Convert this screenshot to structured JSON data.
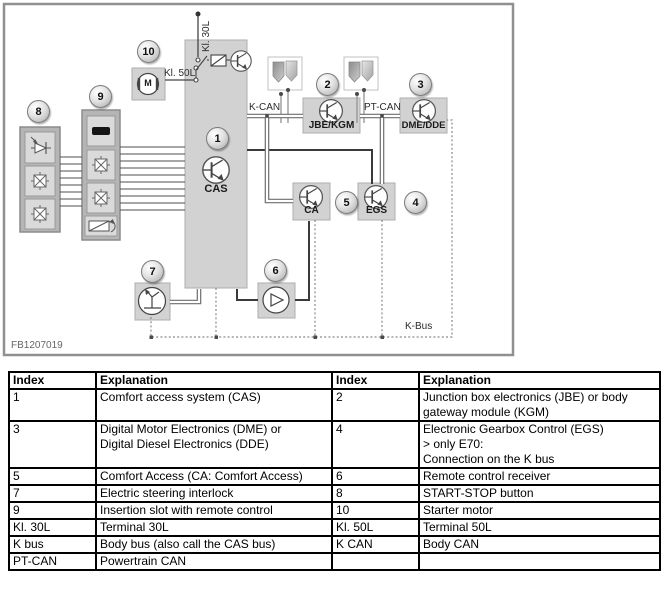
{
  "diagram": {
    "figure_id": "FB1207019",
    "labels": {
      "kl30l": "Kl. 30L",
      "kl50l": "Kl. 50L",
      "kcan": "K-CAN",
      "ptcan": "PT-CAN",
      "kbus": "K-Bus",
      "cas": "CAS",
      "jbe_kgm": "JBE/KGM",
      "dme_dde": "DME/DDE",
      "ca": "CA",
      "egs": "EGS",
      "motor_m": "M"
    },
    "badges": [
      "1",
      "2",
      "3",
      "4",
      "5",
      "6",
      "7",
      "8",
      "9",
      "10"
    ]
  },
  "table": {
    "headers": [
      "Index",
      "Explanation",
      "Index",
      "Explanation"
    ],
    "rows": [
      [
        "1",
        "Comfort access system (CAS)",
        "2",
        "Junction box electronics (JBE) or body gateway module (KGM)"
      ],
      [
        "3",
        "Digital Motor Electronics (DME) or\nDigital Diesel Electronics (DDE)",
        "4",
        "Electronic Gearbox Control (EGS)\n> only E70:\nConnection on the K bus"
      ],
      [
        "5",
        "Comfort Access (CA: Comfort Access)",
        "6",
        "Remote control receiver"
      ],
      [
        "7",
        "Electric steering interlock",
        "8",
        "START-STOP button"
      ],
      [
        "9",
        "Insertion slot with remote control",
        "10",
        "Starter motor"
      ],
      [
        "Kl. 30L",
        "Terminal 30L",
        "Kl. 50L",
        "Terminal 50L"
      ],
      [
        "K bus",
        "Body bus (also call the CAS bus)",
        "K CAN",
        "Body CAN"
      ],
      [
        "PT-CAN",
        "Powertrain CAN",
        "",
        ""
      ]
    ]
  }
}
